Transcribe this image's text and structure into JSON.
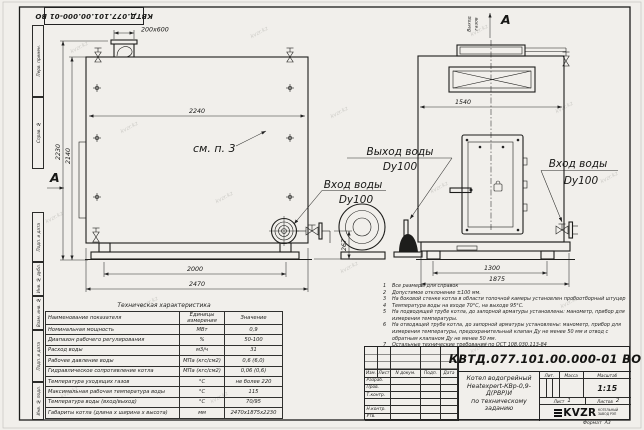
{
  "sheet": {
    "stamp": "КВТД.077.101.00.000-01 ВО",
    "format_label": "Формат",
    "format_value": "А3",
    "watermark": "kvzr.kz"
  },
  "margin": {
    "perv": "Перв. примен.",
    "sprav": "Справ. №",
    "podp1": "Подп. и дата",
    "inv_dubl": "Инв. № дубл.",
    "vzam": "Взам. инв. №",
    "podp2": "Подп. и дата",
    "inv_podl": "Инв. № подл."
  },
  "drawing": {
    "view_label": "А",
    "flue_word1": "Выход",
    "flue_word2": "газов",
    "see_item": "см. п. 3",
    "water_out": "Выход воды",
    "water_out_dn": "Dy100",
    "water_in": "Вход воды",
    "water_in_dn": "Dy100",
    "water_in_r": "Вход воды",
    "water_in_r_dn": "Dy100",
    "dims": {
      "chimney": "200х600",
      "top_width": "2240",
      "h_total": "2230",
      "h_body": "2140",
      "base": "2000",
      "length": "2470",
      "outlet_h": "267",
      "front_width": "1540",
      "front_base": "1300",
      "front_overall": "1875"
    }
  },
  "table": {
    "title": "Техническая характеристика",
    "headers": [
      "Наименование показателя",
      "Единицы измерения",
      "Значение"
    ],
    "rows": [
      [
        "Номинальная мощность",
        "МВт",
        "0,9"
      ],
      [
        "Диапазон рабочего регулирования",
        "%",
        "50-100"
      ],
      [
        "Расход воды",
        "м3/ч",
        "31"
      ],
      [
        "Рабочее давление воды",
        "МПа (кгс/см2)",
        "0,6 (6,0)"
      ],
      [
        "Гидравлическое сопротивление котла",
        "МПа (кгс/см2)",
        "0,06 (0,6)"
      ],
      [
        "Температура уходящих газов",
        "°С",
        "не более 220"
      ],
      [
        "Максимальная рабочая температура воды",
        "°С",
        "115"
      ],
      [
        "Температура воды (вход/выход)",
        "°С",
        "70/95"
      ],
      [
        "Габариты котла (длина х ширина х высота)",
        "мм",
        "2470х1875х2230"
      ]
    ]
  },
  "notes": {
    "items": [
      {
        "n": "1",
        "text": "Все размеры для справок"
      },
      {
        "n": "2",
        "text": "Допустимое отклонение ±100 мм."
      },
      {
        "n": "3",
        "text": "На боковой стенке котла в области топочной камеры установлен пробоотборный штуцер"
      },
      {
        "n": "4",
        "text": "Температура воды на входе 70°С, на выходе 95°С."
      },
      {
        "n": "5",
        "text": "На подводящей трубе котла, до запорной арматуры установлены: манометр, прибор для измерения температуры."
      },
      {
        "n": "6",
        "text": "На отводящей трубе котла, до запорной арматуры установлены: манометр, прибор для измерения температуры, предохранительный клапан Ду не менее 50 мм и отвод с обратным клапаном Ду не менее 50 мм."
      },
      {
        "n": "7",
        "text": "Остальные технические требования по ОСТ 108.030.113-84"
      }
    ]
  },
  "titleblock": {
    "doc_number": "КВТД.077.101.00.000-01 ВО",
    "desc1": "Котел водогрейный",
    "desc2": "Heatexpert-КВр-0,9-Д(РВР)И",
    "desc3": "по техническому заданию",
    "cols": [
      "Изм.",
      "Лист",
      "N докум.",
      "Подп.",
      "Дата"
    ],
    "roles": [
      "Разраб.",
      "Пров.",
      "Т.контр.",
      "",
      "Н.контр.",
      "Утв."
    ],
    "lit_label": "Лит.",
    "mass_label": "Масса",
    "scale_label": "Масштаб",
    "scale": "1:15",
    "sheet_label": "Лист",
    "sheet_no": "1",
    "sheets_label": "Листов",
    "sheets_no": "2",
    "logo": "KVZR",
    "logo_line1": "КОТЕЛЬНЫЙ",
    "logo_line2": "ЗАВОД РЭП"
  }
}
